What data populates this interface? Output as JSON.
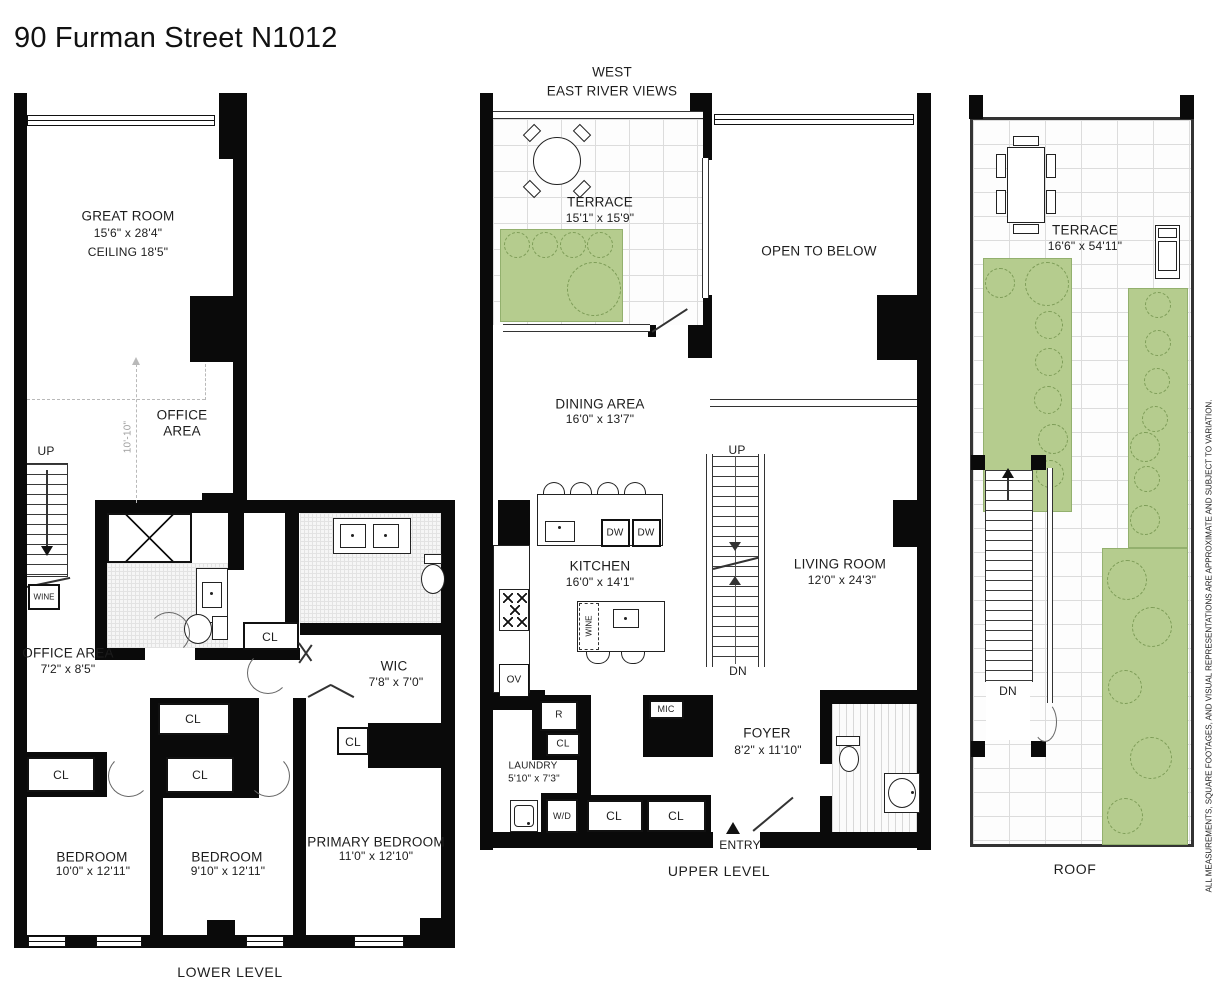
{
  "title": "90 Furman Street N1012",
  "disclaimer": "ALL MEASUREMENTS, SQUARE FOOTAGES, AND VISUAL REPRESENTATIONS ARE APPROXIMATE AND SUBJECT TO VARIATION.",
  "colors": {
    "wall": "#0a0a0a",
    "planter_green": "#b5cc8e",
    "tree_outline": "#7d9c57",
    "tile_line": "#dcdcdc"
  },
  "lower": {
    "caption": "LOWER LEVEL",
    "great_room": {
      "name": "GREAT ROOM",
      "dims": "15'6\" x 28'4\"",
      "ceiling": "CEILING 18'5\""
    },
    "office_upper": {
      "line1": "OFFICE",
      "line2": "AREA"
    },
    "height_dim": "10'-10\"",
    "up": "UP",
    "wine": "WINE",
    "office": {
      "name": "OFFICE AREA",
      "dims": "7'2\" x 8'5\""
    },
    "cl": "CL",
    "wic": {
      "name": "WIC",
      "dims": "7'8\" x 7'0\""
    },
    "bedroom1": {
      "name": "BEDROOM",
      "dims": "10'0\" x 12'11\""
    },
    "bedroom2": {
      "name": "BEDROOM",
      "dims": "9'10\" x 12'11\""
    },
    "primary": {
      "name": "PRIMARY BEDROOM",
      "dims": "11'0\" x 12'10\""
    }
  },
  "upper": {
    "caption": "UPPER LEVEL",
    "west": "WEST",
    "views": "EAST RIVER VIEWS",
    "terrace": {
      "name": "TERRACE",
      "dims": "15'1\" x 15'9\""
    },
    "open_below": "OPEN TO BELOW",
    "dining": {
      "name": "DINING AREA",
      "dims": "16'0\" x 13'7\""
    },
    "kitchen": {
      "name": "KITCHEN",
      "dims": "16'0\" x 14'1\""
    },
    "living": {
      "name": "LIVING ROOM",
      "dims": "12'0\" x 24'3\""
    },
    "foyer": {
      "name": "FOYER",
      "dims": "8'2\" x 11'10\""
    },
    "laundry": {
      "name": "LAUNDRY",
      "dims": "5'10\" x 7'3\""
    },
    "up": "UP",
    "dn": "DN",
    "dw": "DW",
    "ov": "OV",
    "r": "R",
    "mic": "MIC",
    "wd": "W/D",
    "wine": "WINE",
    "cl": "CL",
    "entry": "ENTRY"
  },
  "roof": {
    "caption": "ROOF",
    "terrace": {
      "name": "TERRACE",
      "dims": "16'6\" x 54'11\""
    },
    "dn": "DN"
  }
}
